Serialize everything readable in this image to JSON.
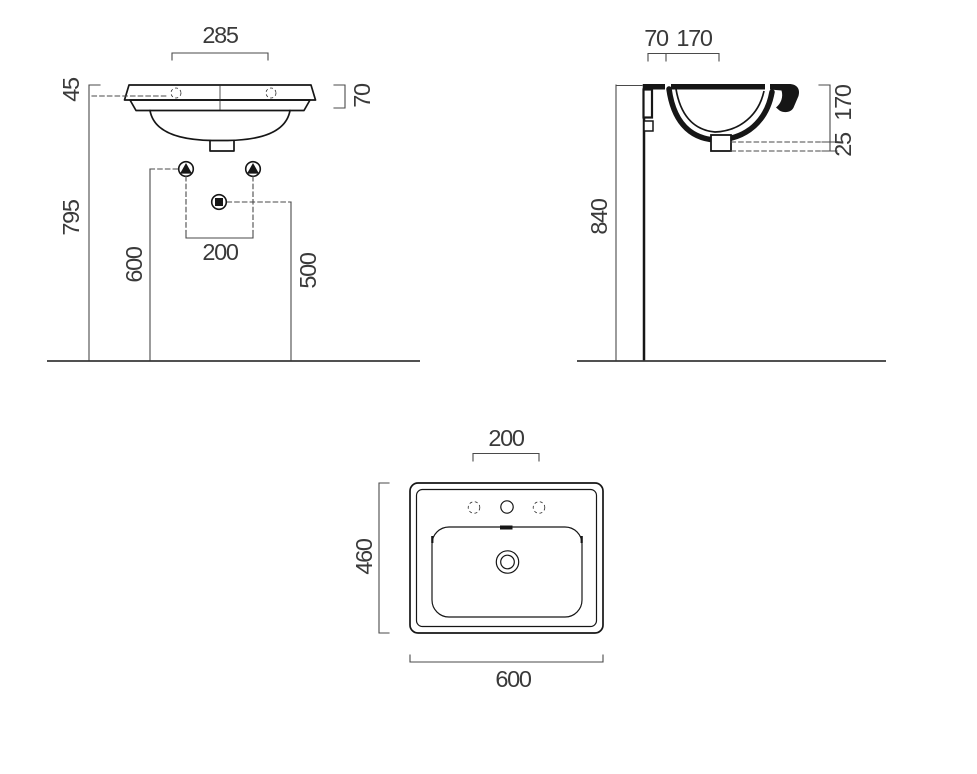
{
  "drawing": {
    "type": "washbasin-technical-drawing",
    "background": "#ffffff",
    "line_color": "#161616",
    "dim_color": "#4a4a4a",
    "views": {
      "front": {
        "label": "front-elevation",
        "dims": {
          "width": "285",
          "lip": "45",
          "rim": "70",
          "height": "795",
          "fixings": "600",
          "waste": "500",
          "spacing": "200"
        }
      },
      "side": {
        "label": "side-section",
        "dims": {
          "offset": "70",
          "depth": "170",
          "height": "840",
          "drop": "170",
          "trap": "25"
        }
      },
      "top": {
        "label": "plan-view",
        "dims": {
          "spacing": "200",
          "depth": "460",
          "width": "600"
        }
      }
    }
  }
}
